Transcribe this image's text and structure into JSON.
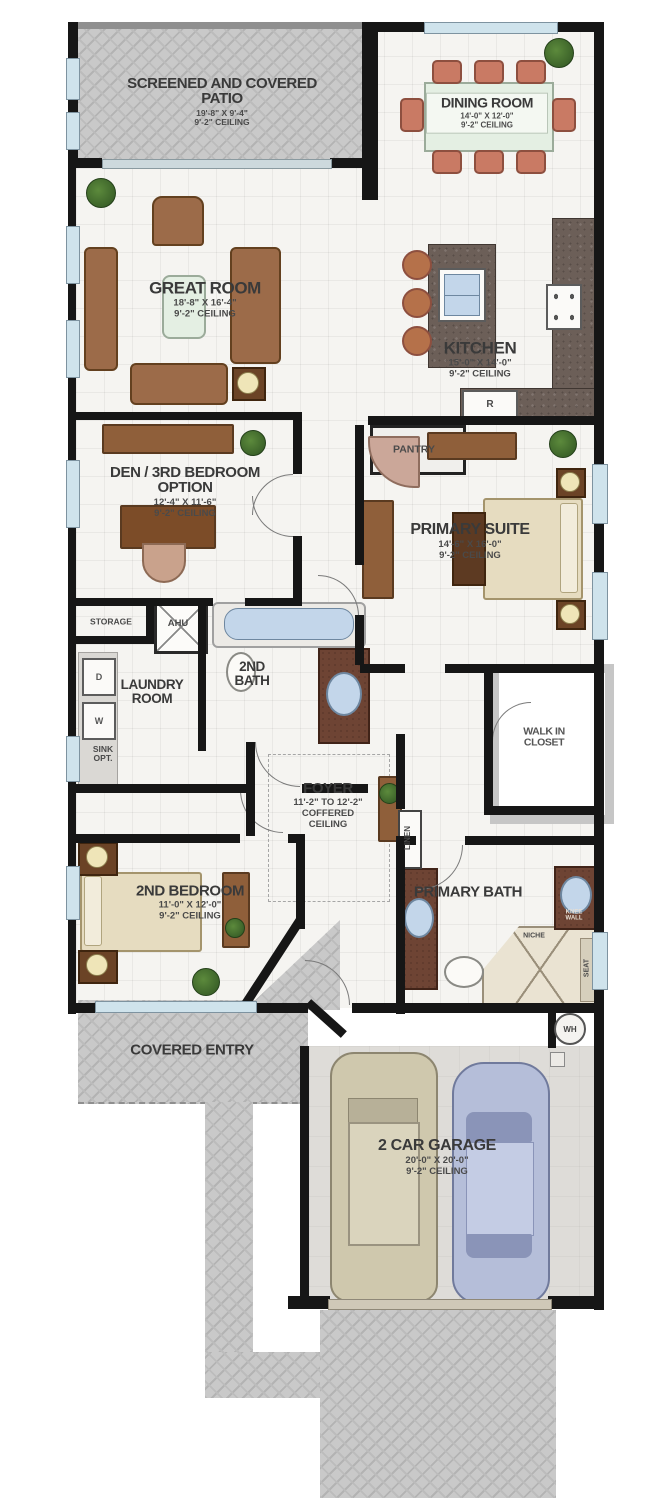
{
  "plan": {
    "rooms": {
      "patio": {
        "name": "SCREENED AND COVERED PATIO",
        "dims": "19'-8\" X 9'-4\"",
        "ceiling": "9'-2\" CEILING"
      },
      "dining": {
        "name": "DINING ROOM",
        "dims": "14'-0\" X 12'-0\"",
        "ceiling": "9'-2\" CEILING"
      },
      "great": {
        "name": "GREAT ROOM",
        "dims": "18'-8\" X 16'-4\"",
        "ceiling": "9'-2\" CEILING"
      },
      "kitchen": {
        "name": "KITCHEN",
        "dims": "15'-0\" X 14'-0\"",
        "ceiling": "9'-2\" CEILING",
        "pantry": "PANTRY",
        "fridge": "R"
      },
      "den": {
        "name": "DEN / 3RD BEDROOM OPTION",
        "dims": "12'-4\" X 11'-6\"",
        "ceiling": "9'-2\" CEILING"
      },
      "primary_suite": {
        "name": "PRIMARY SUITE",
        "dims": "14'-6\" X 16'-0\"",
        "ceiling": "9'-2\" CEILING"
      },
      "storage": {
        "name": "STORAGE"
      },
      "ahu": {
        "name": "AHU"
      },
      "laundry": {
        "name": "LAUNDRY ROOM",
        "dryer": "D",
        "washer": "W",
        "sink_option": "SINK OPT."
      },
      "second_bath": {
        "name": "2ND BATH"
      },
      "foyer": {
        "name": "FOYER",
        "height": "11'-2\" TO 12'-2\"",
        "ceiling": "COFFERED CEILING"
      },
      "walk_in_closet": {
        "name": "WALK IN CLOSET"
      },
      "linen": {
        "name": "LINEN"
      },
      "second_bedroom": {
        "name": "2ND BEDROOM",
        "dims": "11'-0\" X 12'-0\"",
        "ceiling": "9'-2\" CEILING"
      },
      "primary_bath": {
        "name": "PRIMARY BATH",
        "knee_wall": "KNEE WALL",
        "niche": "NICHE",
        "seat": "SEAT"
      },
      "water_heater": {
        "name": "WH"
      },
      "covered_entry": {
        "name": "COVERED ENTRY"
      },
      "garage": {
        "name": "2 CAR GARAGE",
        "dims": "20'-0\" X 20'-0\"",
        "ceiling": "9'-2\" CEILING"
      }
    },
    "colors": {
      "wall": "#161616",
      "paver": "#c9c9c9",
      "floor": "#f5f4f1",
      "granite": "#6c5f58",
      "wood": "#8f5f3a",
      "upholstery": "#c97a64",
      "bed": "#e6dcc0",
      "window": "#cfe3ec",
      "garage_floor": "#dedcd8",
      "car_tan": "#cfc8ad",
      "car_blue": "#b5bed9",
      "plant": "#3e6b2f",
      "vanity": "#6e4434",
      "water": "#c3d6ea"
    }
  }
}
